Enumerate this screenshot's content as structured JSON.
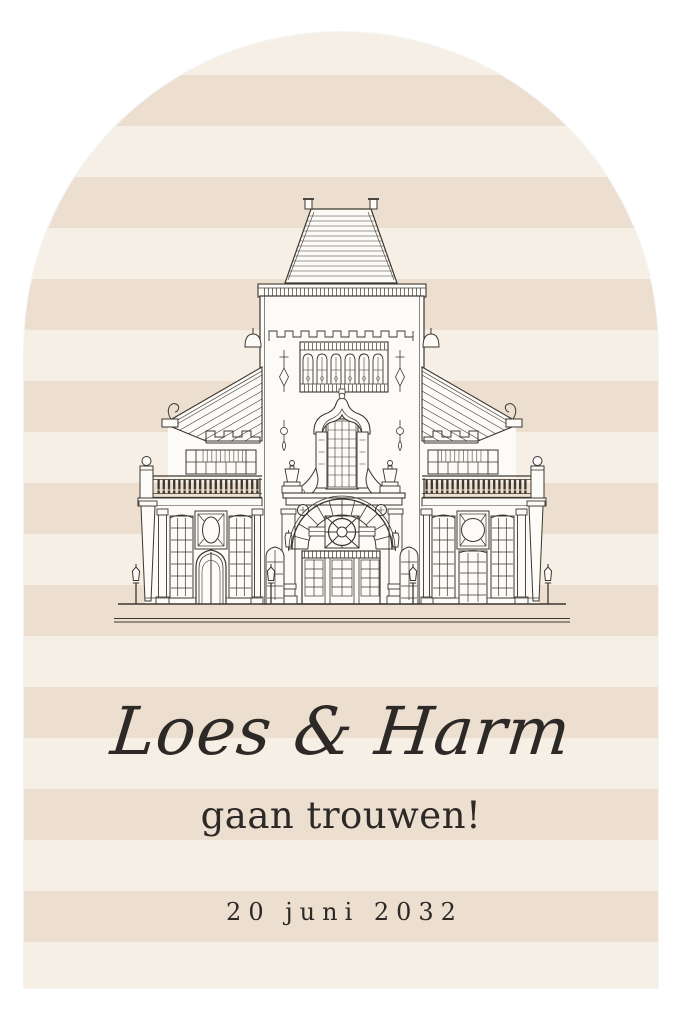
{
  "invitation": {
    "names": "Loes & Harm",
    "subtitle": "gaan trouwen!",
    "date": "20 juni 2032",
    "illustration": "venue-building-line-drawing",
    "colors": {
      "page_background": "#ffffff",
      "stripe_light": "#f6efe6",
      "stripe_dark": "#ecdfd0",
      "line_art": "#3c362f",
      "building_fill": "#fdfbf7",
      "text": "#2d2926"
    }
  }
}
